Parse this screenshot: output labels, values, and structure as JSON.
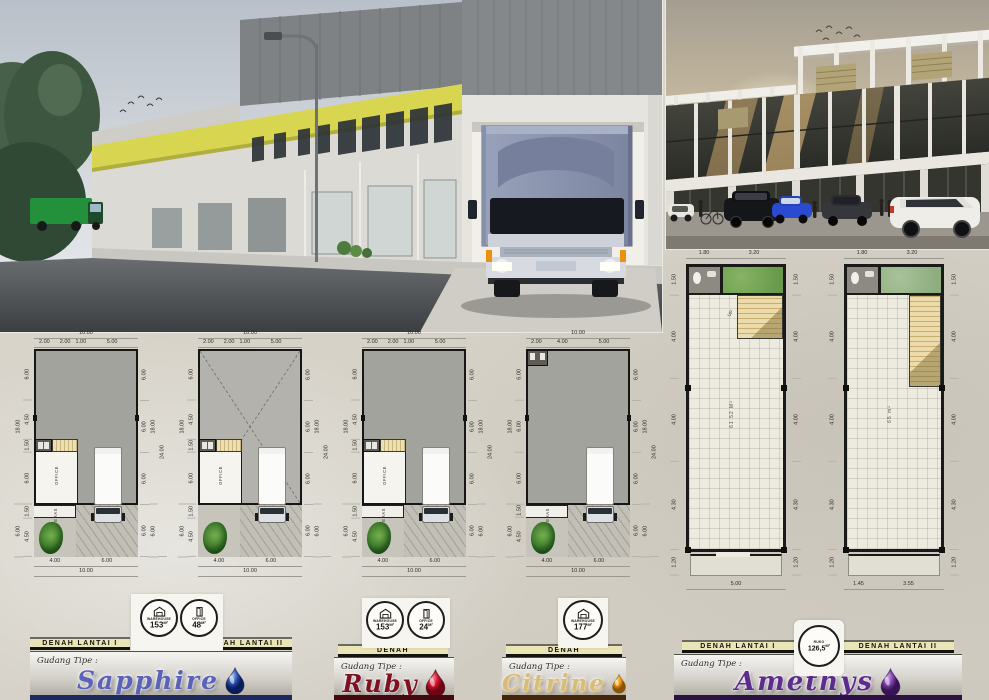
{
  "page": {
    "background_color": "#d6d2c8",
    "accent_yellow": "#d8d650"
  },
  "renders": {
    "main": {
      "name": "warehouse-street-render"
    },
    "secondary": {
      "name": "ruko-facade-render"
    }
  },
  "plans": [
    {
      "key": "sapphire-lantai-1",
      "top_total": "10.00",
      "top_segs": [
        "2.00",
        "2.00",
        "1.00",
        "5.00"
      ],
      "left_outer": [
        "18.00",
        "6.00"
      ],
      "left_inner": [
        "6.00",
        "4.50",
        "1.50",
        "6.00",
        "1.50",
        "4.50"
      ],
      "right_inner": [
        "6.00",
        "6.00",
        "6.00",
        "6.00"
      ],
      "right_mid": [
        "18.00",
        "6.00"
      ],
      "right_outer": [
        "24.00"
      ],
      "bottom_segs": [
        "4.00",
        "6.00"
      ],
      "bottom_total": "10.00",
      "office_label": "OFFICE",
      "teras_label": "TERAS"
    },
    {
      "key": "sapphire-lantai-2",
      "top_total": "10.00",
      "top_segs": [
        "2.00",
        "2.00",
        "1.00",
        "5.00"
      ],
      "left_outer": [
        "18.00",
        "6.00"
      ],
      "left_inner": [
        "6.00",
        "4.50",
        "1.50",
        "6.00",
        "1.50",
        "4.50"
      ],
      "right_inner": [
        "6.00",
        "6.00",
        "6.00",
        "6.00"
      ],
      "right_mid": [
        "18.00",
        "6.00"
      ],
      "right_outer": [
        "24.00"
      ],
      "bottom_segs": [
        "4.00",
        "6.00"
      ],
      "bottom_total": "10.00",
      "office_label": "OFFICE"
    },
    {
      "key": "ruby-denah",
      "top_total": "10.00",
      "top_segs": [
        "2.00",
        "2.00",
        "1.00",
        "5.00"
      ],
      "left_outer": [
        "18.00",
        "6.00"
      ],
      "left_inner": [
        "6.00",
        "4.50",
        "1.50",
        "6.00",
        "1.50",
        "4.50"
      ],
      "right_inner": [
        "6.00",
        "6.00",
        "6.00",
        "6.00"
      ],
      "right_mid": [
        "18.00",
        "6.00"
      ],
      "right_outer": [
        "24.00"
      ],
      "bottom_segs": [
        "4.00",
        "6.00"
      ],
      "bottom_total": "10.00",
      "office_label": "OFFICE",
      "teras_label": "TERAS"
    },
    {
      "key": "citrine-denah",
      "top_total": "10.00",
      "top_segs": [
        "2.00",
        "4.00",
        "5.00"
      ],
      "left_outer": [
        "18.00",
        "6.00"
      ],
      "left_inner": [
        "6.00",
        "6.00",
        "6.00",
        "1.50",
        "4.50"
      ],
      "right_inner": [
        "6.00",
        "6.00",
        "6.00",
        "6.00"
      ],
      "right_mid": [
        "18.00",
        "6.00"
      ],
      "right_outer": [
        "24.00"
      ],
      "bottom_segs": [
        "4.00",
        "6.00"
      ],
      "bottom_total": "10.00",
      "teras_label": "TERAS"
    },
    {
      "key": "amethys-lantai-1",
      "top_segs": [
        "1.80",
        "3.20"
      ],
      "left_segs": [
        "1.50",
        "4.00",
        "4.00",
        "4.30",
        "1.20"
      ],
      "right_segs": [
        "1.50",
        "4.00",
        "4.00",
        "4.30",
        "1.20"
      ],
      "bottom_total": "5.00",
      "room_label": "61.52 M²",
      "stair_label": "UP"
    },
    {
      "key": "amethys-lantai-2",
      "top_segs": [
        "1.80",
        "3.20"
      ],
      "left_segs": [
        "1.50",
        "4.00",
        "4.00",
        "4.30",
        "1.20"
      ],
      "right_segs": [
        "1.50",
        "4.00",
        "4.00",
        "4.30",
        "1.20"
      ],
      "bottom_segs": [
        "1.45",
        "3.55"
      ],
      "room_label": "65 m²"
    }
  ],
  "sections": [
    {
      "key": "sapphire",
      "bar_labels": [
        "DENAH LANTAI I",
        "DENAH LANTAI II"
      ],
      "gudang_label": "Gudang Tipe :",
      "name": "Sapphire",
      "name_color": "#5a63b8",
      "bottom_strip_color": "#1d2a5e",
      "gem_icon": "sapphire-gem-icon",
      "badges": [
        {
          "icon": "warehouse-icon",
          "label": "WAREHOUSE",
          "value": "153",
          "unit": "M²"
        },
        {
          "icon": "office-door-icon",
          "label": "OFFICE",
          "value": "48",
          "unit": "M²"
        }
      ]
    },
    {
      "key": "ruby",
      "bar_labels": [
        "DENAH"
      ],
      "gudang_label": "Gudang Tipe :",
      "name": "Ruby",
      "name_color": "#7e1020",
      "bottom_strip_color": "#46080f",
      "gem_icon": "ruby-gem-icon",
      "badges": [
        {
          "icon": "warehouse-icon",
          "label": "WAREHOUSE",
          "value": "153",
          "unit": "M²"
        },
        {
          "icon": "office-door-icon",
          "label": "OFFICE",
          "value": "24",
          "unit": "M²"
        }
      ]
    },
    {
      "key": "citrine",
      "bar_labels": [
        "DENAH"
      ],
      "gudang_label": "Gudang Tipe :",
      "name": "Citrine",
      "name_color": "#d9bd74",
      "bottom_strip_color": "#46260a",
      "gem_icon": "citrine-gem-icon",
      "badges": [
        {
          "icon": "warehouse-icon",
          "label": "WAREHOUSE",
          "value": "177",
          "unit": "M²"
        }
      ]
    },
    {
      "key": "amethys",
      "bar_labels": [
        "DENAH LANTAI I",
        "DENAH LANTAI II"
      ],
      "gudang_label": "Gudang Tipe :",
      "name": "Amethys",
      "name_color": "#5e2c8c",
      "bottom_strip_color": "#2c1244",
      "gem_icon": "amethys-gem-icon",
      "badges": [
        {
          "icon": "ruko-icon",
          "label": "RUKO",
          "value": "126,5",
          "unit": "M²"
        }
      ]
    }
  ],
  "gem_colors": {
    "sapphire": [
      "#aecdf2",
      "#2c55b4",
      "#0a1c5e"
    ],
    "ruby": [
      "#ff93a0",
      "#d41230",
      "#6e0412"
    ],
    "citrine": [
      "#ffd978",
      "#ec9715",
      "#8f5305"
    ],
    "amethys": [
      "#cfa6ea",
      "#8244ae",
      "#381356"
    ]
  }
}
